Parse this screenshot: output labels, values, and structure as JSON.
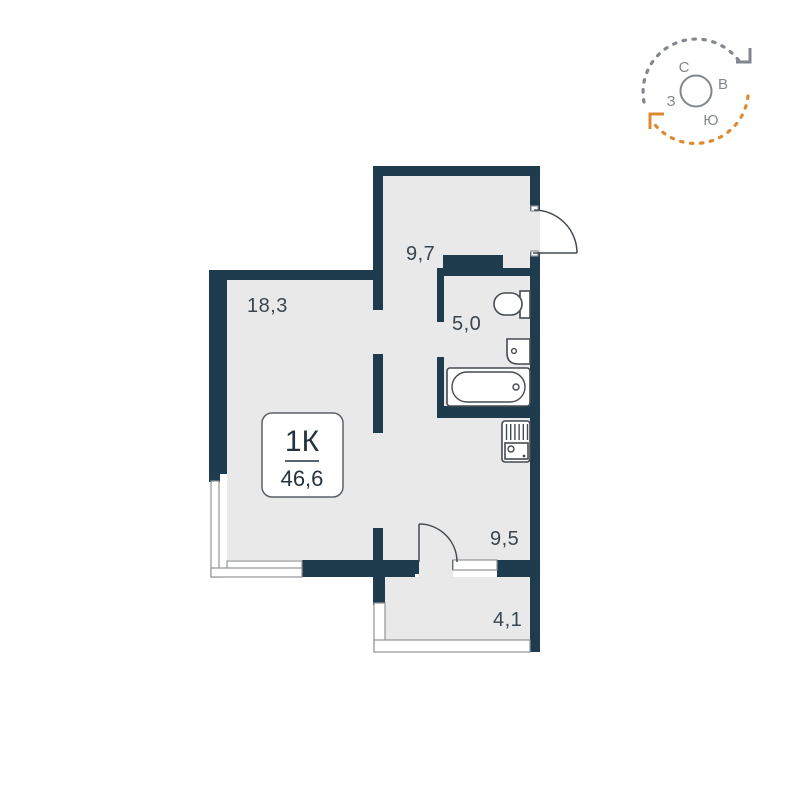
{
  "colors": {
    "wall": "#1e3c4e",
    "floor": "#e9e9e9",
    "line": "#454b52",
    "window_stroke": "#8f9296",
    "label_text": "#3a454e",
    "badge_border": "#5a6166",
    "badge_text": "#24333e",
    "compass_gray": "#82868d",
    "accent_orange": "#dd8b2f"
  },
  "apartment": {
    "type_label": "1К",
    "total_area": "46,6"
  },
  "rooms": [
    {
      "name": "living-room",
      "area": "18,3"
    },
    {
      "name": "hallway",
      "area": "9,7"
    },
    {
      "name": "bathroom",
      "area": "5,0"
    },
    {
      "name": "kitchen",
      "area": "9,5"
    },
    {
      "name": "balcony",
      "area": "4,1"
    }
  ],
  "compass": {
    "north": "С",
    "east": "В",
    "south": "Ю",
    "west": "З"
  }
}
